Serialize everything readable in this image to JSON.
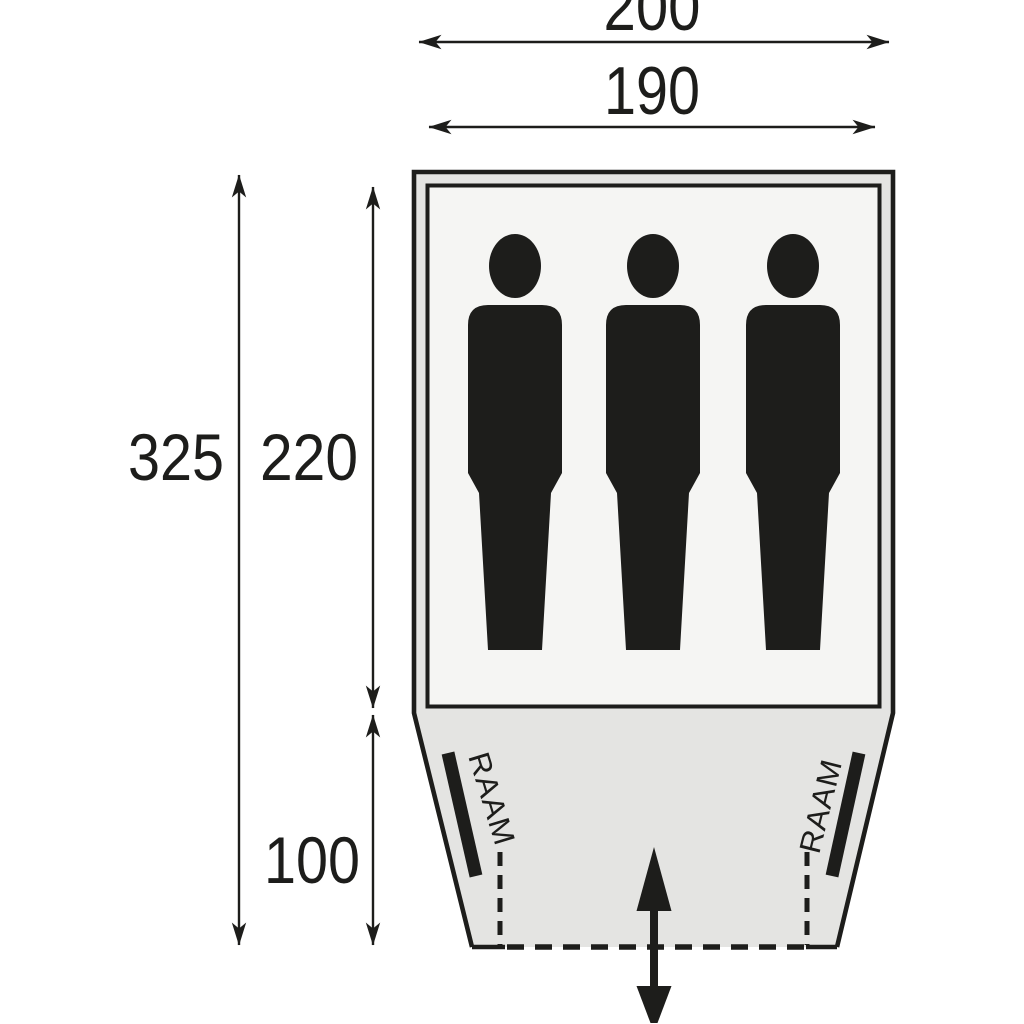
{
  "diagram": {
    "subject": "tent floorplan top view with dimensions",
    "dimension_labels": {
      "outer_width": "200",
      "inner_width": "190",
      "total_depth": "325",
      "sleeping_depth": "220",
      "porch_depth": "100"
    },
    "window_labels": {
      "left": "RAAM",
      "right": "RAAM"
    },
    "capacity_persons": 3,
    "colors": {
      "ink": "#1d1d1b",
      "tent_fill": "#e4e4e2",
      "groundsheet_fill": "#f5f5f3",
      "background": "#ffffff"
    }
  }
}
